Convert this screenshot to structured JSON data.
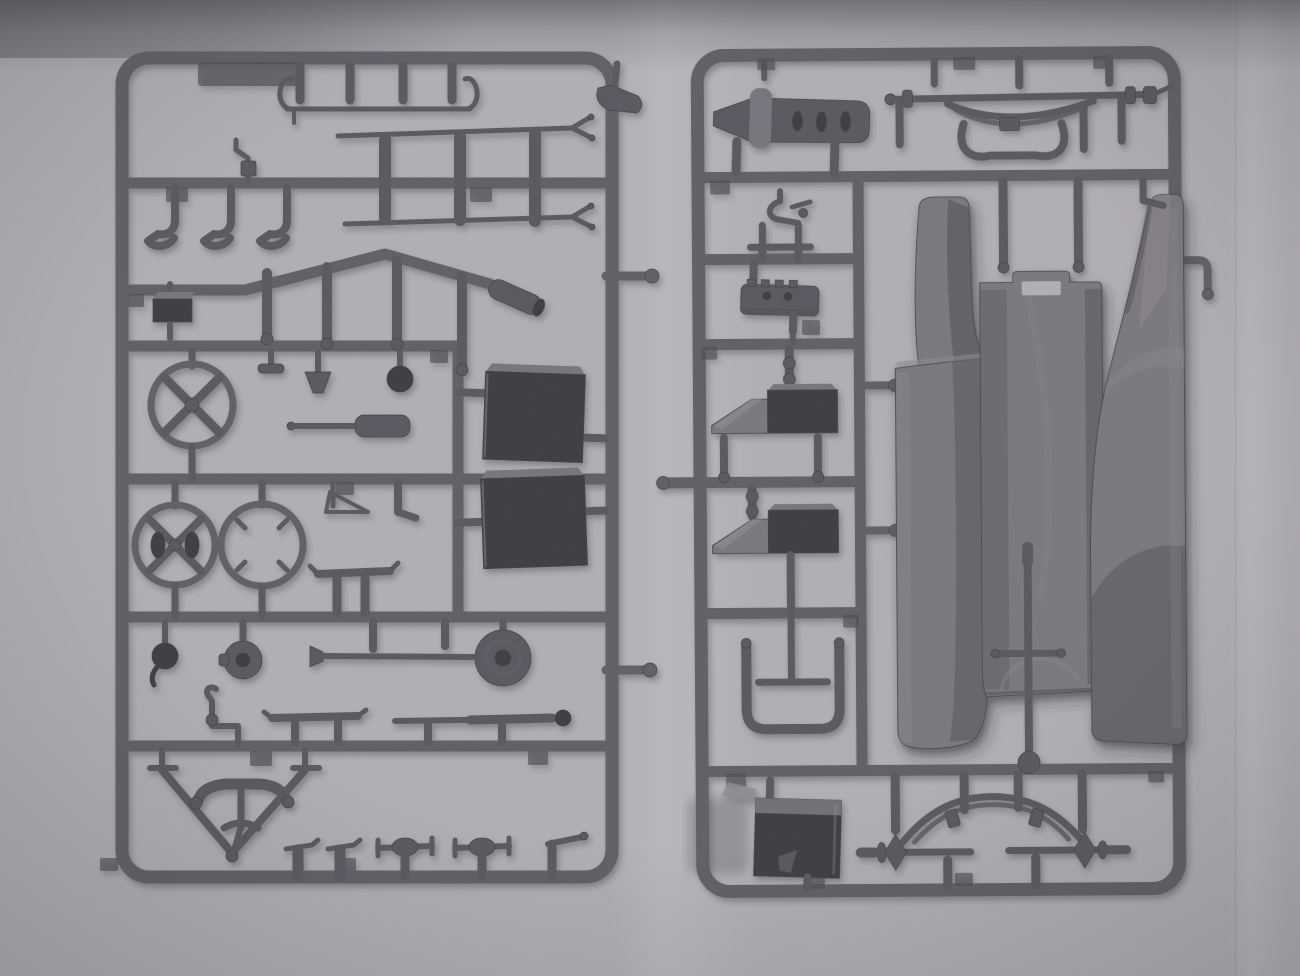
{
  "meta": {
    "kind": "photograph",
    "subject": "two grey injection-molded plastic model-kit sprues (part frames) lying on light grey folded paper, photographed from above",
    "sprue_count": 2,
    "visible_text": ""
  },
  "palette": {
    "bg": "#b1aeb4",
    "bg_deep": "#a19ea4",
    "fold": "#c6c3c9",
    "shadow_top": "#4b494f",
    "sprue": "#615f66",
    "sprue_dark": "#434147",
    "sprue_mid": "#77757b",
    "part": "#5a585f",
    "part_dark": "#3d3c42",
    "panel": "#7a777d",
    "panel_light": "#8d8a90",
    "panel_mid": "#6b696f",
    "panel_dark": "#525055",
    "tab": "#4e4c53"
  },
  "sprue_a": {
    "name": "left sprue - small detail parts",
    "plastic_color": "grey",
    "parts": [
      "hanger-bar",
      "mounting-pins",
      "curved-blade",
      "tie-rod-long",
      "tie-rod-short",
      "link-pins",
      "pedal-arms",
      "hand-lever",
      "bent-exhaust-runner",
      "muffler",
      "hanging-pins",
      "small-tool-box",
      "steering-wheel",
      "filler-cap",
      "funnel",
      "gear-knob",
      "gun-barrel-cylinder",
      "fuel-tank-front",
      "fuel-tank-rear",
      "spoked-wheel",
      "hubbed-wheel",
      "open-wheel-rim",
      "wire-bracket",
      "elbow-pin",
      "small-leaf-spring",
      "horn",
      "brake-drum",
      "pan-rod",
      "crank-handle",
      "leaf-spring-left",
      "leaf-spring-right",
      "tow-triangle",
      "handlebar-bow",
      "tie-pins",
      "axle-spindle-1",
      "axle-spindle-2",
      "bent-lever"
    ]
  },
  "sprue_b": {
    "name": "right sprue - body panels and axles",
    "plastic_color": "grey",
    "parts": [
      "engine-plank",
      "cross-bracket",
      "front-axle",
      "front-leaf-spring",
      "steering-linkage",
      "mounting-pins",
      "valve-lever",
      "bolt-plate",
      "ramp-wedge-front",
      "storage-block-front",
      "ramp-wedge-rear",
      "storage-block-rear",
      "seat-frame",
      "battery-box",
      "left-fender-panel",
      "floor-panel",
      "right-fender-panel",
      "steering-column",
      "rear-axle",
      "rear-leaf-spring",
      "axle-pins",
      "outside-hook"
    ]
  }
}
